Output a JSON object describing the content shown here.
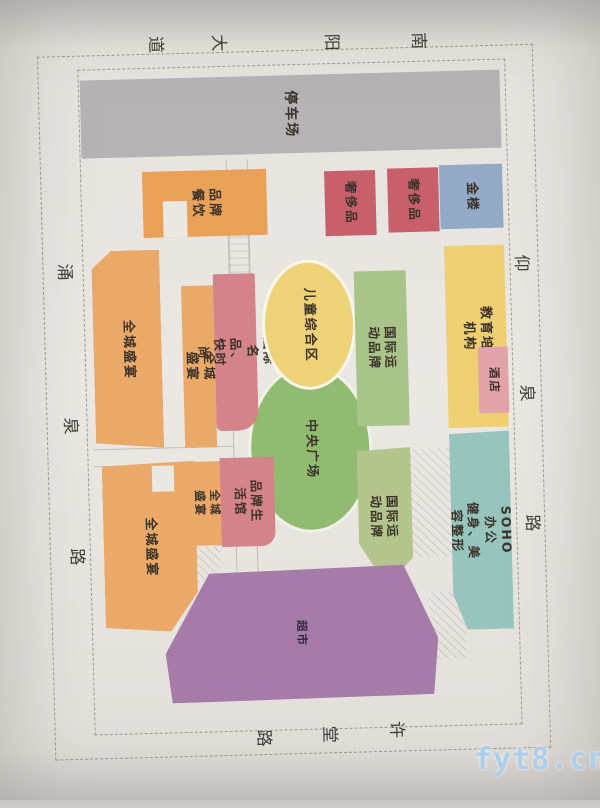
{
  "streets": {
    "top": {
      "name": "南阳大道",
      "chars": [
        "南",
        "阳",
        "大",
        "道"
      ]
    },
    "left": {
      "name": "涌泉路",
      "chars": [
        "涌",
        "泉",
        "路"
      ]
    },
    "right": {
      "name": "仰泉路",
      "chars": [
        "仰",
        "泉",
        "路"
      ]
    },
    "bottom": {
      "name": "许堂路",
      "chars": [
        "许",
        "堂",
        "路"
      ]
    }
  },
  "blocks": {
    "parking": {
      "label": "停车场",
      "color": "#b5b3b4"
    },
    "brand_dining": {
      "label": "品牌\n餐饮",
      "color": "#e8a157"
    },
    "luxury_1": {
      "label": "奢侈品",
      "color": "#c8606c"
    },
    "luxury_2": {
      "label": "奢侈品",
      "color": "#c8606c"
    },
    "gold_house": {
      "label": "金楼",
      "color": "#93aac6"
    },
    "city_feast_1": {
      "label": "全城盛宴",
      "color": "#eaa968"
    },
    "city_feast_2": {
      "label": "全城盛宴",
      "color": "#eaa968"
    },
    "intl_brands_fashion": {
      "label": "国际名品、快时尚",
      "color": "#d5838b"
    },
    "kids_zone": {
      "label": "儿童综合区",
      "color": "#eed277"
    },
    "central_plaza": {
      "label": "中央广场",
      "color": "#90bb70"
    },
    "intl_sports_1": {
      "label": "国际运动品牌",
      "color": "#a9c489"
    },
    "education": {
      "label": "教育培训机构",
      "color": "#eecf72"
    },
    "hotel": {
      "label": "酒店",
      "color": "#e2a3ab"
    },
    "city_feast_3": {
      "label": "全城盛宴",
      "color": "#eaa968"
    },
    "city_feast_4": {
      "label": "全城盛宴",
      "color": "#eaa968"
    },
    "brand_lifestyle": {
      "label": "品牌生活馆",
      "color": "#d5838b"
    },
    "intl_sports_2": {
      "label": "国际运动品牌",
      "color": "#b3c48d"
    },
    "soho": {
      "label": "SOHO办公\n健身、美容整形",
      "color": "#97c5bd"
    },
    "supermarket": {
      "label": "超市",
      "color": "#a77ba8"
    }
  },
  "watermark": "fyt8.cn",
  "colors": {
    "paper": "#ebe8e4",
    "boundary_dash": "#9e988f",
    "label_text": "#3c332a"
  }
}
